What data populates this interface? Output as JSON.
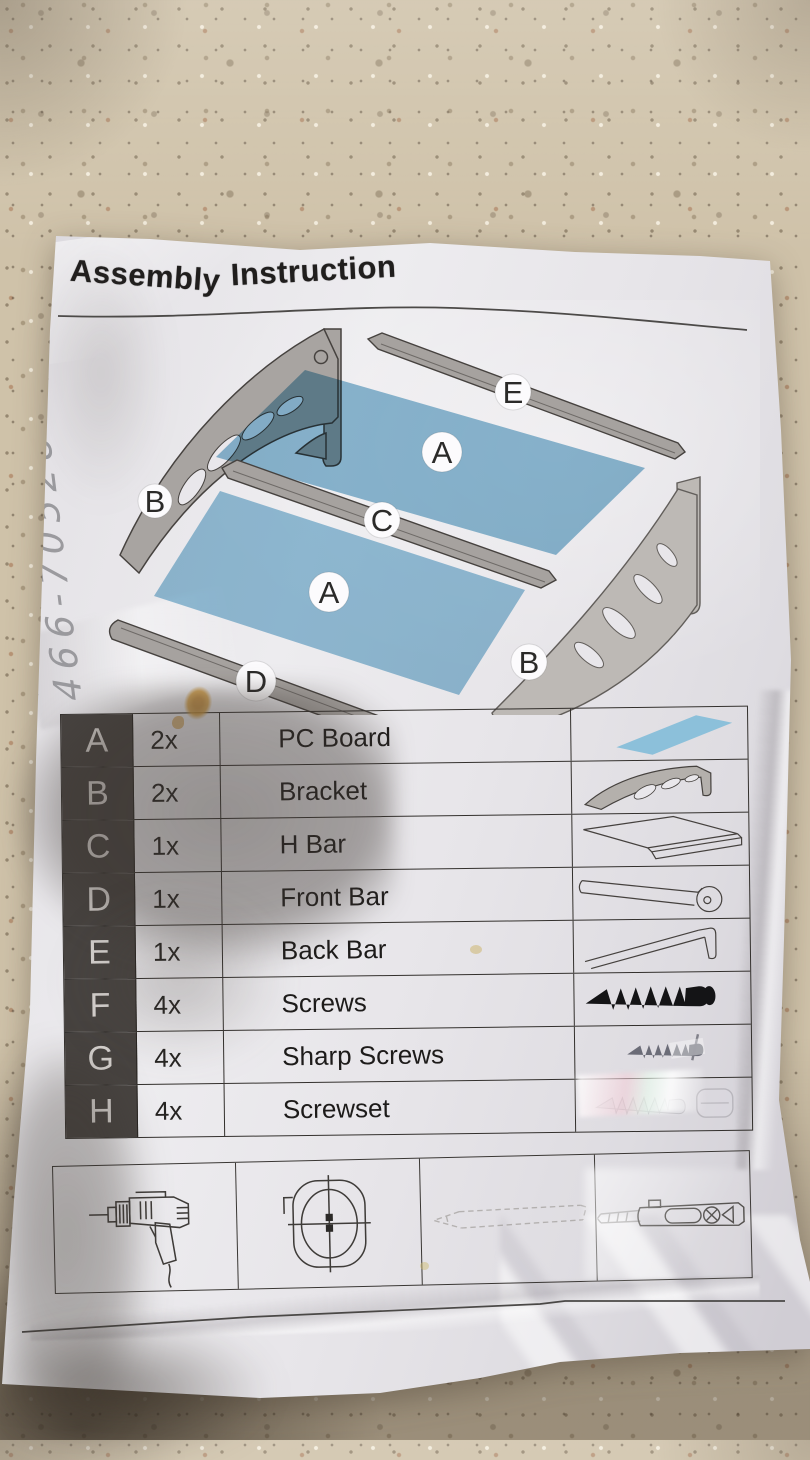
{
  "sheet": {
    "title_words": {
      "w1": "Assembly",
      "w2": "Instruction"
    }
  },
  "handwriting": {
    "note": "466-70528"
  },
  "diagram": {
    "labels": {
      "left_bracket": "B",
      "back_bar": "E",
      "panel_top": "A",
      "h_bar": "C",
      "panel_bottom": "A",
      "front_bar": "D",
      "right_bracket": "B"
    }
  },
  "parts": {
    "rows": [
      {
        "id": "A",
        "qty": "2x",
        "name": "PC Board",
        "icon": "pc-board-icon"
      },
      {
        "id": "B",
        "qty": "2x",
        "name": "Bracket",
        "icon": "bracket-icon"
      },
      {
        "id": "C",
        "qty": "1x",
        "name": "H Bar",
        "icon": "h-bar-icon"
      },
      {
        "id": "D",
        "qty": "1x",
        "name": "Front Bar",
        "icon": "front-bar-icon"
      },
      {
        "id": "E",
        "qty": "1x",
        "name": "Back Bar",
        "icon": "back-bar-icon"
      },
      {
        "id": "F",
        "qty": "4x",
        "name": "Screws",
        "icon": "screw-icon"
      },
      {
        "id": "G",
        "qty": "4x",
        "name": "Sharp Screws",
        "icon": "sharp-screw-icon"
      },
      {
        "id": "H",
        "qty": "4x",
        "name": "Screwset",
        "icon": "screwset-icon"
      }
    ]
  },
  "tools": {
    "icons": [
      "power-drill-icon",
      "tape-measure-icon",
      "pencil-icon",
      "utility-knife-icon"
    ]
  },
  "colors": {
    "panel_blue": "#8abcd6",
    "paper": "#e8e6ea",
    "countertop": "#d3c6ae",
    "table_letter_bg": "#474340",
    "ink": "#201e1d",
    "pencil_gray": "#8e8e92"
  }
}
